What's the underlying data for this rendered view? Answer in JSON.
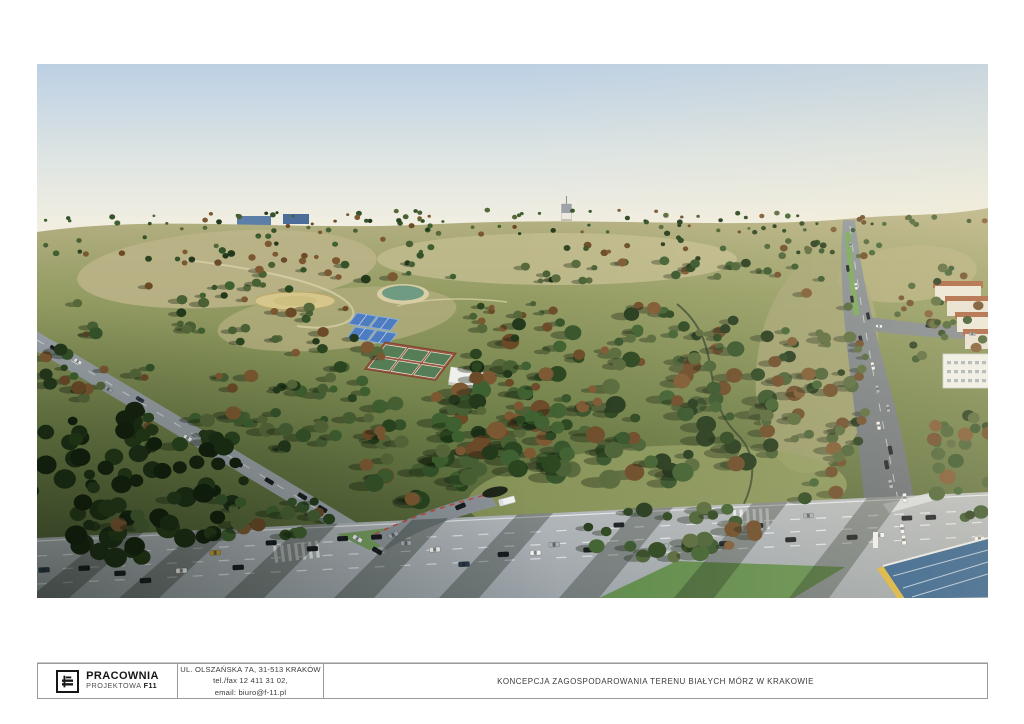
{
  "page": {
    "background": "#ffffff"
  },
  "render": {
    "alt": "Aerial visualization of the Białe Morza park development in Kraków: wooded parkland with tennis and clay sports courts, a pond, meadows, a white sanctuary tower on the horizon, busy multi-lane roads with traffic in the foreground and apartment buildings on the right",
    "colors": {
      "sky_top": "#bcd0e4",
      "sky_mid": "#dde4e3",
      "horizon": "#f1eee1",
      "terrain_top": "#b8b287",
      "terrain_mid": "#949c63",
      "terrain_low": "#6b7c46",
      "terrain_shadow": "#44552f",
      "sand": "#cfc198",
      "meadow_light": "#c2bb8d",
      "road_light": "#b6babe",
      "road_mid": "#9aa2a8",
      "asphalt_top": "#8e969c",
      "asphalt_dark": "#555c63",
      "median_green": "#74a65a",
      "court_blue": "#4e7cc0",
      "court_blue_light": "#86aede",
      "court_clay": "#9a5740",
      "court_green": "#557e57",
      "pond": "#6f9b82",
      "pond_rim": "#d8cda4",
      "tower_white": "#ece9e2",
      "roof_red": "#a9613f",
      "building_white": "#efefec",
      "station_blue": "#2e5d8c",
      "station_yellow": "#d9b33a",
      "car_dark": "#171a1f",
      "car_white": "#f2f3f1",
      "car_silver": "#a7adb3",
      "car_navy": "#2c3a4a",
      "car_red": "#7c2a24",
      "car_yellow": "#c8a23a",
      "logo_black": "#161616",
      "titleblock_border": "#9a9a9a",
      "text_dark": "#3a3a3a"
    },
    "tree_palette": [
      "#2a451f",
      "#35532a",
      "#3f6030",
      "#24391c",
      "#56683a",
      "#6b4a28",
      "#7c5832",
      "#486034"
    ],
    "tree_palette_dark": [
      "#15240f",
      "#1c2f15",
      "#12200d",
      "#243a18"
    ]
  },
  "title_block": {
    "logo": {
      "line1": "PRACOWNIA",
      "line2": "PROJEKTOWA",
      "line2_bold": "F11"
    },
    "address": {
      "line1": "UL. OLSZAŃSKA 7A, 31-513 KRAKÓW",
      "line2": "tel./fax 12 411 31 02,",
      "line3": "email: biuro@f-11.pl"
    },
    "project_title": "KONCEPCJA ZAGOSPODAROWANIA TERENU BIAŁYCH MÓRZ W KRAKOWIE"
  }
}
